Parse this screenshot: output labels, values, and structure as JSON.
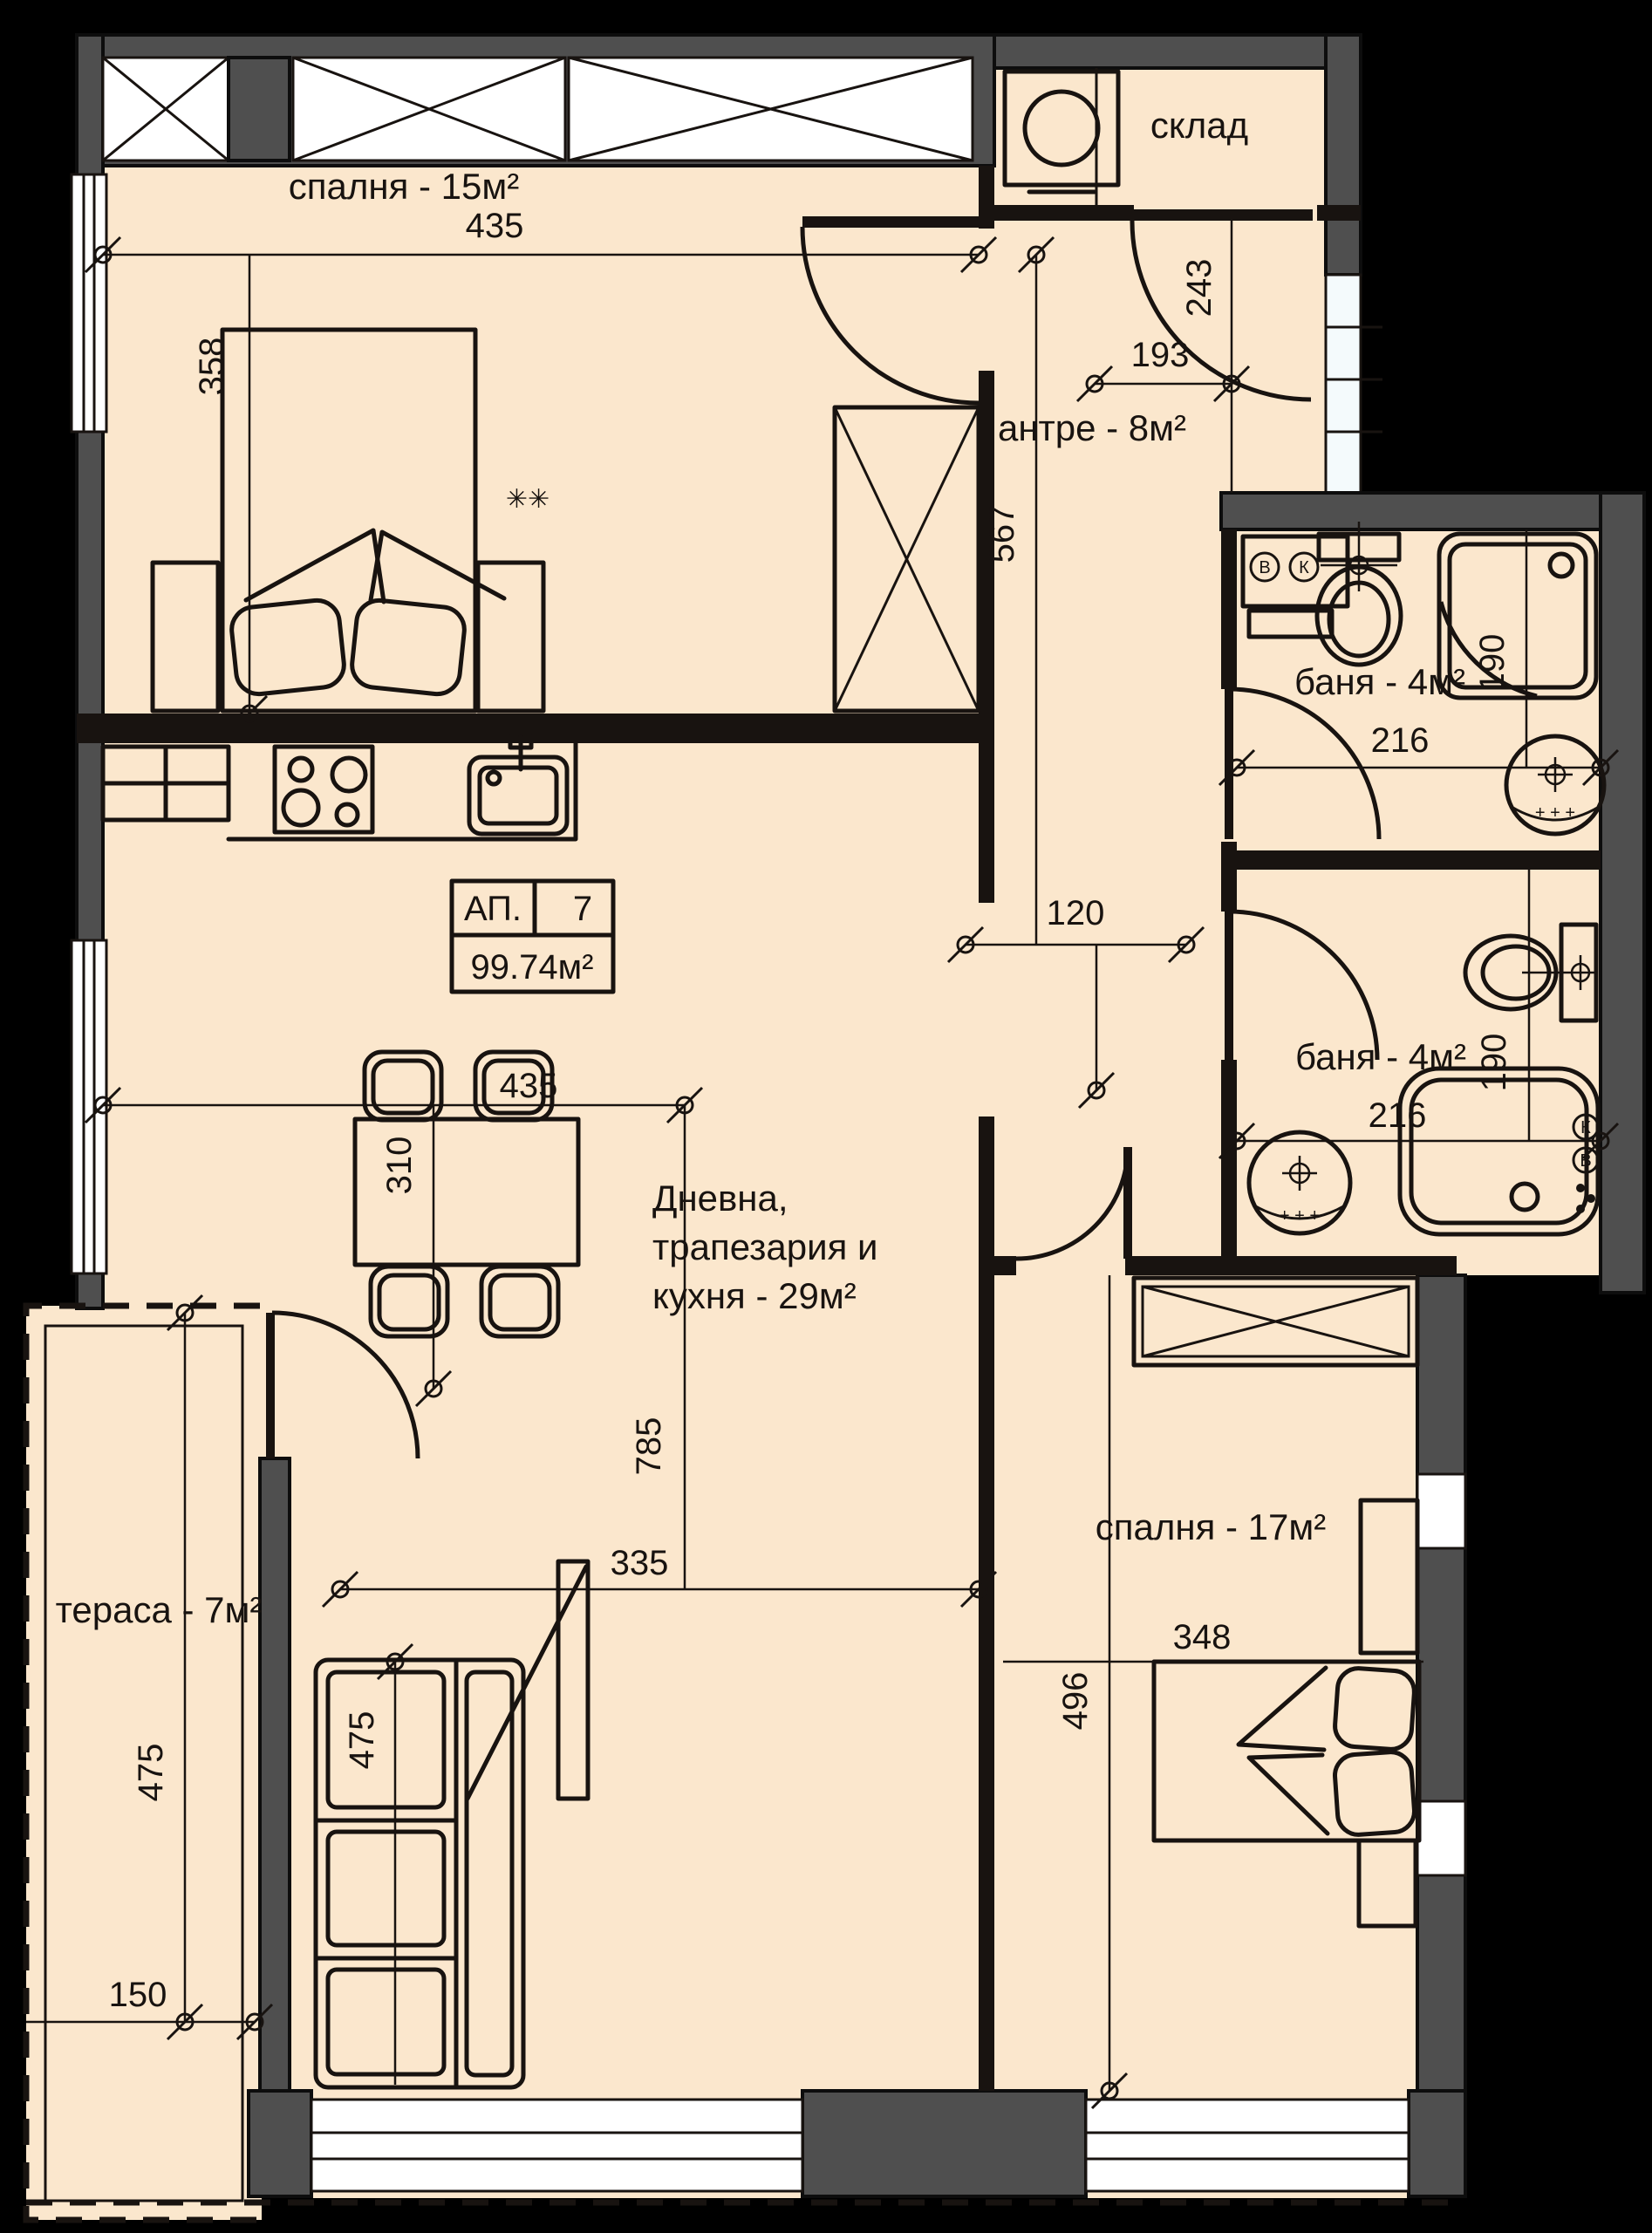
{
  "apartment": {
    "label": "АП.",
    "number": "7",
    "area": "99.74м²"
  },
  "rooms": {
    "storage": "склад",
    "bedroom1": "спалня - 15м²",
    "entry": "антре - 8м²",
    "bath1": "баня - 4м²",
    "bath2": "баня - 4м²",
    "living1": "Дневна,",
    "living2": "трапезария и",
    "living3": "кухня - 29м²",
    "terrace": "тераса - 7м²",
    "bedroom2": "спалня - 17м²"
  },
  "dims": {
    "bedroom1_w": "435",
    "bedroom1_h": "358",
    "entry_w": "193",
    "entry_h2": "243",
    "entry_h": "567",
    "bath1_w": "216",
    "bath1_h": "190",
    "hall_w": "120",
    "dining_w": "435",
    "dining_h": "310",
    "bath2_w": "216",
    "bath2_h": "190",
    "living_w": "335",
    "living_h": "785",
    "terrace_h": "475",
    "terrace_w": "150",
    "sofa_h": "475",
    "bed2_w": "348",
    "bedroom2_h": "496"
  },
  "symbols": {
    "marks": "✳✳",
    "valve_hot": "В",
    "valve_cold": "К"
  },
  "colors": {
    "floor": "#fbe7cd",
    "wall": "#4f4f4f",
    "line": "#181310",
    "window": "#f4fafc",
    "background": "#000000"
  }
}
